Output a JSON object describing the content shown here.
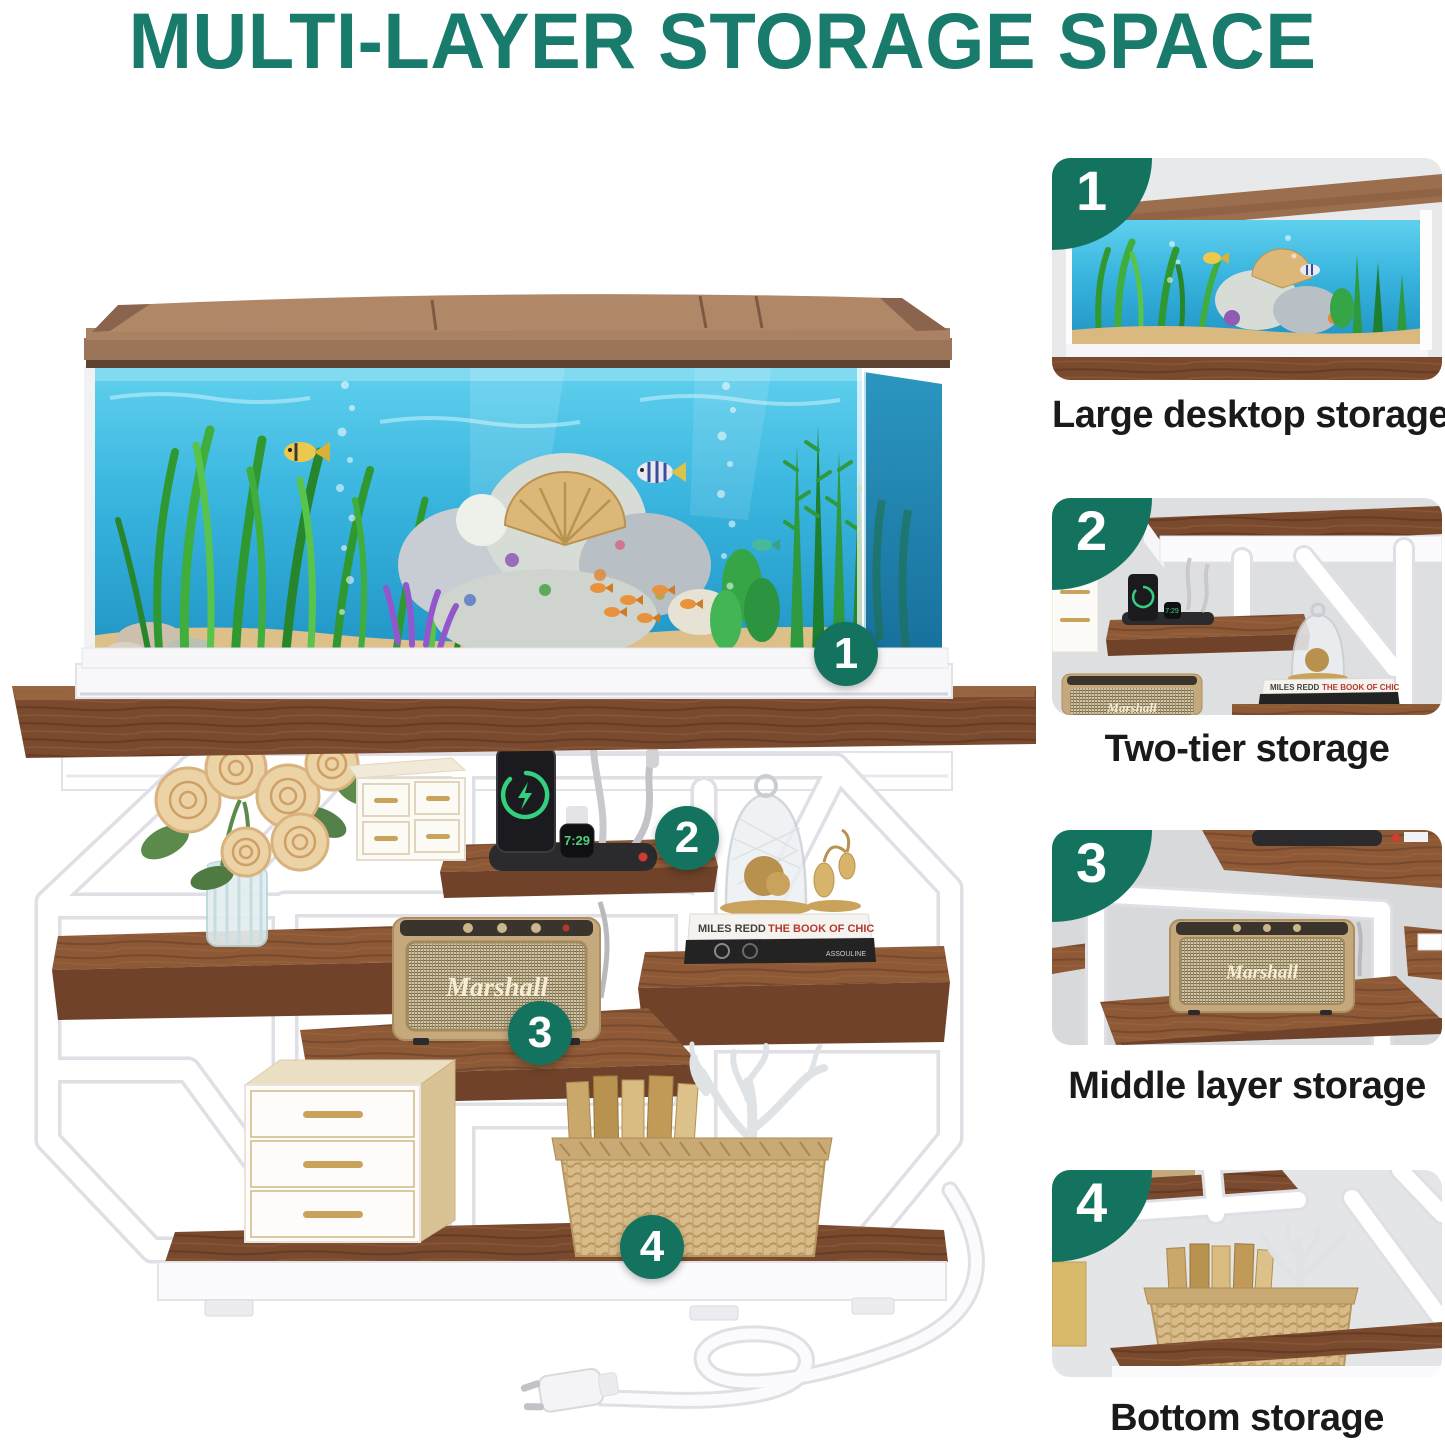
{
  "title": "MULTI-LAYER STORAGE SPACE",
  "colors": {
    "accent": "#177c6c",
    "badge": "#14735f",
    "caption": "#1a1a1a",
    "wood": "#7a4a2f",
    "water_top": "#5fd0ee",
    "water_bottom": "#1f93c4"
  },
  "main": {
    "badges": [
      "1",
      "2",
      "3",
      "4"
    ],
    "watch_time": "7:29",
    "speaker_brand": "Marshall",
    "book_author": "MILES REDD",
    "book_title": "THE BOOK OF CHIC",
    "book_publisher": "ASSOULINE"
  },
  "sidebar": {
    "items": [
      {
        "number": "1",
        "caption": "Large desktop storage"
      },
      {
        "number": "2",
        "caption": "Two-tier storage"
      },
      {
        "number": "3",
        "caption": "Middle layer storage"
      },
      {
        "number": "4",
        "caption": "Bottom storage"
      }
    ]
  }
}
